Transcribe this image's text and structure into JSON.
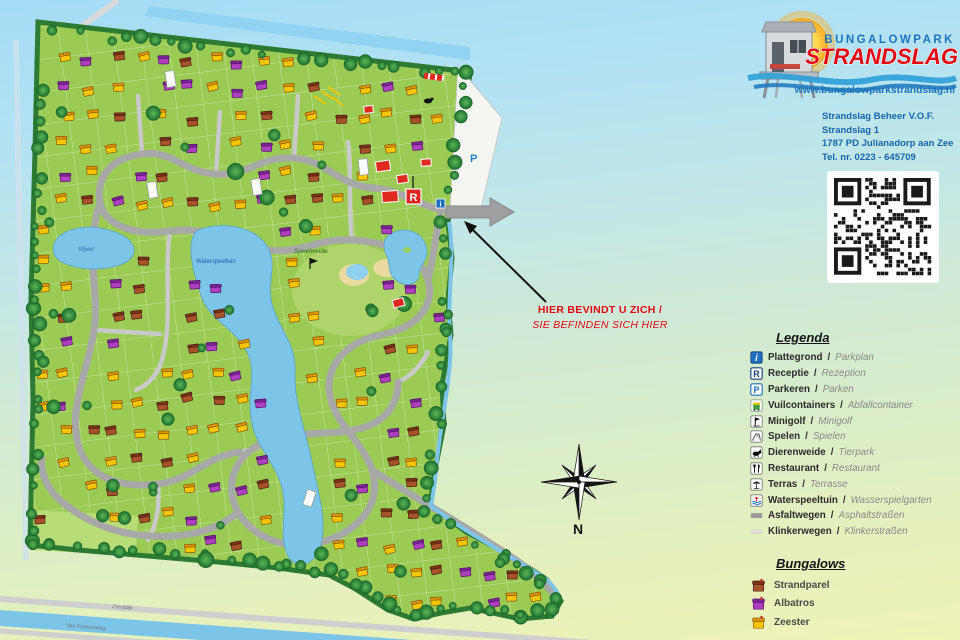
{
  "logo": {
    "brand_top": "BUNGALOWPARK",
    "brand_main": "STRANDSLAG",
    "website": "www.bungalowparkstrandslag.nl"
  },
  "contact": {
    "lines": [
      "Strandslag Beheer V.O.F.",
      "Strandslag 1",
      "1787 PD Julianadorp aan Zee",
      "Tel. nr. 0223 - 645709"
    ]
  },
  "you_are_here": {
    "line1": "HIER BEVINDT U ZICH /",
    "line2": "SIE BEFINDEN SICH HIER"
  },
  "compass": {
    "label": "N"
  },
  "legend": {
    "title": "Legenda",
    "separator": "/",
    "items": [
      {
        "icon": "info",
        "nl": "Plattegrond",
        "de": "Parkplan"
      },
      {
        "icon": "reception",
        "nl": "Receptie",
        "de": "Rezeption"
      },
      {
        "icon": "parking",
        "nl": "Parkeren",
        "de": "Parken"
      },
      {
        "icon": "waste",
        "nl": "Vuilcontainers",
        "de": "Abfallcontainer"
      },
      {
        "icon": "minigolf",
        "nl": "Minigolf",
        "de": "Minigolf"
      },
      {
        "icon": "play",
        "nl": "Spelen",
        "de": "Spielen"
      },
      {
        "icon": "animals",
        "nl": "Dierenweide",
        "de": "Tierpark"
      },
      {
        "icon": "restaurant",
        "nl": "Restaurant",
        "de": "Restaurant"
      },
      {
        "icon": "terrace",
        "nl": "Terras",
        "de": "Terrasse"
      },
      {
        "icon": "waterplay",
        "nl": "Waterspeeltuin",
        "de": "Wasserspielgarten"
      },
      {
        "icon": "asphalt",
        "nl": "Asfaltwegen",
        "de": "Asphaltstraßen"
      },
      {
        "icon": "paved",
        "nl": "Klinkerwegen",
        "de": "Klinkerstraßen"
      }
    ]
  },
  "bungalow_types": {
    "title": "Bungalows",
    "items": [
      {
        "type": "s",
        "name": "Strandparel",
        "color": "#a8522b"
      },
      {
        "type": "a",
        "name": "Albatros",
        "color": "#ae3fbe"
      },
      {
        "type": "z",
        "name": "Zeester",
        "color": "#f7c600"
      }
    ]
  },
  "map_labels": {
    "pond": "Vijver",
    "water": "Waterspeeltuin",
    "meadow": "Speelweide",
    "road_top": "Zanddijk",
    "road_bottom": "Van Foreestweg",
    "parking_marker": "P",
    "reception_marker": "R",
    "info_marker": "i"
  },
  "colors": {
    "park_green": "#9ccb55",
    "hedge_green": "#2c7a33",
    "water_blue": "#7cc4e8",
    "road_gray": "#a8a8a8",
    "brand_blue": "#1b75bb",
    "brand_red": "#e30613"
  }
}
